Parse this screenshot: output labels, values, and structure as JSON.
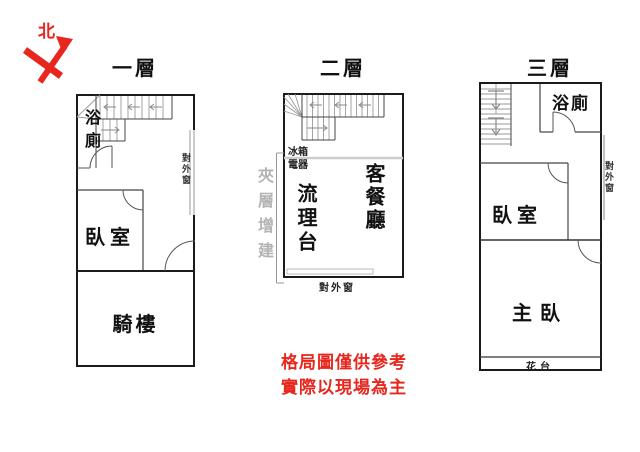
{
  "compass": {
    "north_label": "北"
  },
  "floors": {
    "floor1": {
      "title": "一層",
      "bathroom": "浴廁",
      "bedroom": "臥室",
      "arcade": "騎樓",
      "exterior_window": "對外窗"
    },
    "floor2": {
      "title": "二層",
      "appliance_line1": "冰箱",
      "appliance_line2": "電器",
      "kitchen_counter": "流理台",
      "living_dining": "客餐廳",
      "exterior_window": "對外窗",
      "mezzanine_note": "夾層增建"
    },
    "floor3": {
      "title": "三層",
      "bathroom": "浴廁",
      "bedroom": "臥室",
      "master_bedroom": "主臥",
      "flower_stand": "花台",
      "exterior_window": "對外窗"
    }
  },
  "disclaimer": {
    "line1": "格局圖僅供參考",
    "line2": "實際以現場為主"
  },
  "colors": {
    "accent_red": "#e7271d",
    "wall_black": "#1b1b1b",
    "stair_gray": "#999999",
    "note_gray": "#b3b3b3"
  }
}
